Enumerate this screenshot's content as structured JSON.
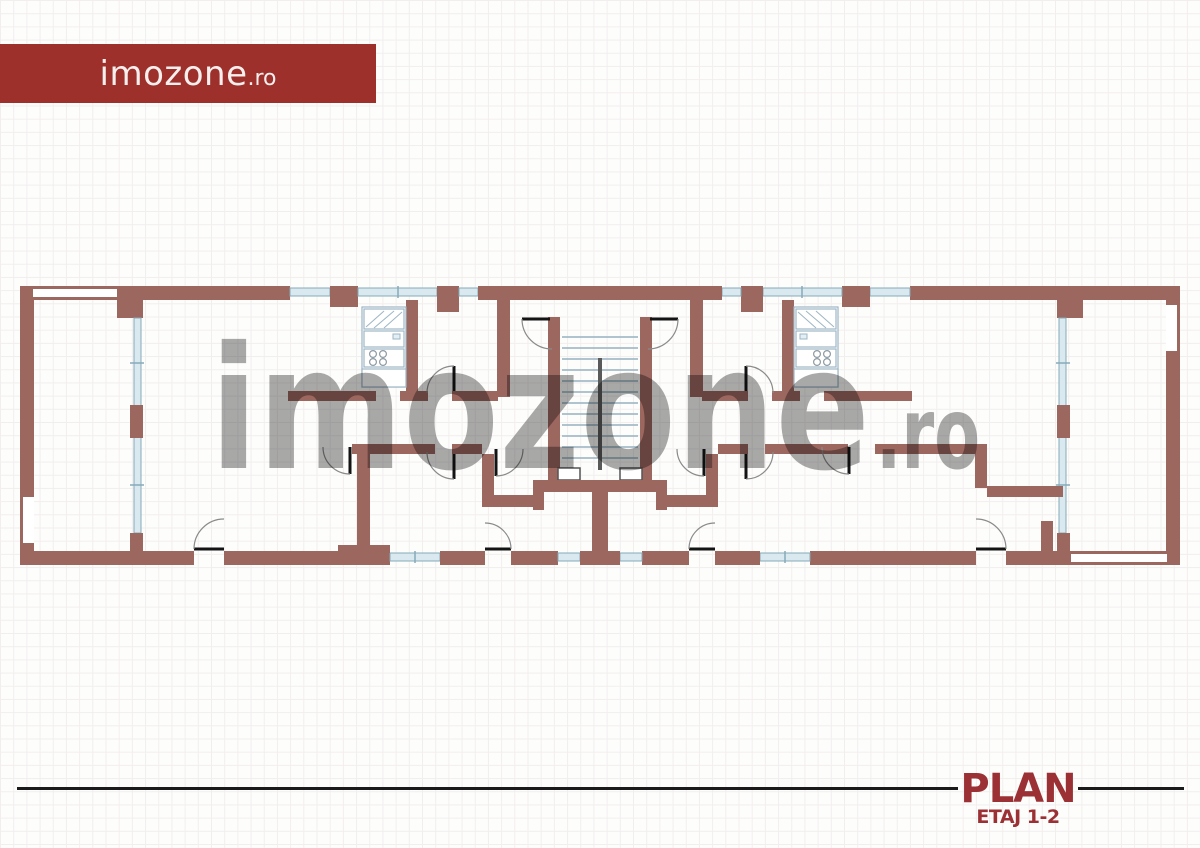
{
  "header": {
    "logo_main": "imozone",
    "logo_suffix": ".ro"
  },
  "watermark": {
    "main": "imozone",
    "suffix": ".ro"
  },
  "footer": {
    "title": "PLAN",
    "subtitle": "ETAJ 1-2"
  },
  "colors": {
    "brand-red": "#9e302b",
    "logo-text": "#f6efee",
    "wall": "#9c675f",
    "window-fill": "#d9e9ef",
    "window-stroke": "#86aaba",
    "door": "#141414",
    "arc": "#8a8a8a",
    "stair-line": "#a4bcc8",
    "watermark": "#a9a9a9",
    "plan-red": "#9b3134",
    "footer-line": "#1b1b1b",
    "grid-line": "#f2eeee",
    "bg": "#fdfdfc"
  }
}
